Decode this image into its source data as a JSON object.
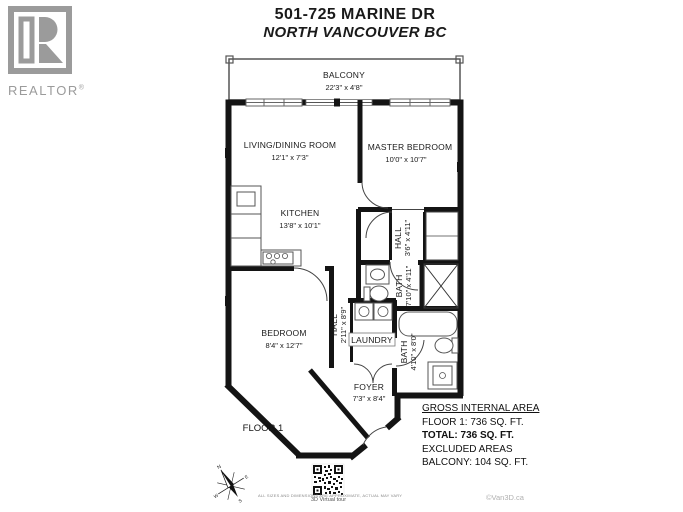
{
  "header": {
    "title": "501-725 MARINE DR",
    "subtitle": "NORTH VANCOUVER BC"
  },
  "logo": {
    "label": "REALTOR",
    "registered": "®"
  },
  "rooms": {
    "balcony": {
      "name": "BALCONY",
      "dims": "22'3\" x 4'8\""
    },
    "living": {
      "name": "LIVING/DINING ROOM",
      "dims": "12'1\" x 7'3\""
    },
    "master": {
      "name": "MASTER BEDROOM",
      "dims": "10'0\" x 10'7\""
    },
    "kitchen": {
      "name": "KITCHEN",
      "dims": "13'8\" x 10'1\""
    },
    "hall_upper": {
      "name": "HALL",
      "dims": "3'6\" x 4'11\""
    },
    "bath_upper": {
      "name": "BATH",
      "dims": "7'10\" x 4'11\""
    },
    "bedroom": {
      "name": "BEDROOM",
      "dims": "8'4\" x 12'7\""
    },
    "hall_lower": {
      "name": "HALL",
      "dims": "2'11\" x 8'9\""
    },
    "laundry": {
      "name": "LAUNDRY"
    },
    "bath_lower": {
      "name": "BATH",
      "dims": "4'10\" x 8'0\""
    },
    "foyer": {
      "name": "FOYER",
      "dims": "7'3\" x 8'4\""
    }
  },
  "floor_label": "FLOOR 1",
  "area_summary": {
    "heading": "GROSS INTERNAL AREA",
    "floor1": "FLOOR 1: 736 SQ. FT.",
    "total": "TOTAL: 736 SQ. FT.",
    "excluded": "EXCLUDED AREAS",
    "balcony": "BALCONY: 104 SQ. FT."
  },
  "footer": {
    "disclaimer": "ALL SIZES AND DIMENSIONS ARE APPROXIMATE, ACTUAL MAY VARY",
    "qr_caption": "3D Virtual tour",
    "copyright": "©Van3D.ca"
  },
  "colors": {
    "wall": "#141414",
    "logo_gray": "#9b9b9b",
    "accent_gray": "#b0b0b0"
  }
}
